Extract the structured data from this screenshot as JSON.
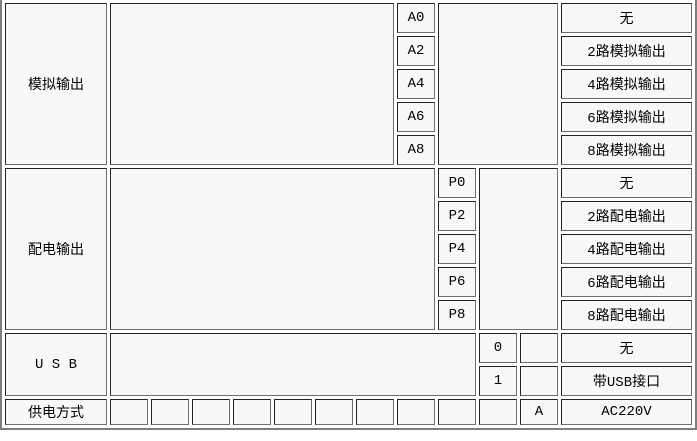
{
  "table": {
    "sections": [
      {
        "label": "模拟输出",
        "rows": [
          {
            "code": "A0",
            "desc": "无"
          },
          {
            "code": "A2",
            "desc": "2路模拟输出"
          },
          {
            "code": "A4",
            "desc": "4路模拟输出"
          },
          {
            "code": "A6",
            "desc": "6路模拟输出"
          },
          {
            "code": "A8",
            "desc": "8路模拟输出"
          }
        ]
      },
      {
        "label": "配电输出",
        "rows": [
          {
            "code": "P0",
            "desc": "无"
          },
          {
            "code": "P2",
            "desc": "2路配电输出"
          },
          {
            "code": "P4",
            "desc": "4路配电输出"
          },
          {
            "code": "P6",
            "desc": "6路配电输出"
          },
          {
            "code": "P8",
            "desc": "8路配电输出"
          }
        ]
      },
      {
        "label": "U S B",
        "rows": [
          {
            "code": "0",
            "desc": "无"
          },
          {
            "code": "1",
            "desc": "带USB接口"
          }
        ]
      },
      {
        "label": "供电方式",
        "rows": [
          {
            "code": "A",
            "desc": "AC220V"
          }
        ]
      }
    ],
    "colors": {
      "cell_background": "#f8f8f8",
      "border_dark": "#222222",
      "border_light": "#6d6d6d",
      "outer_border": "#7d7d7d",
      "text": "#000000"
    }
  }
}
